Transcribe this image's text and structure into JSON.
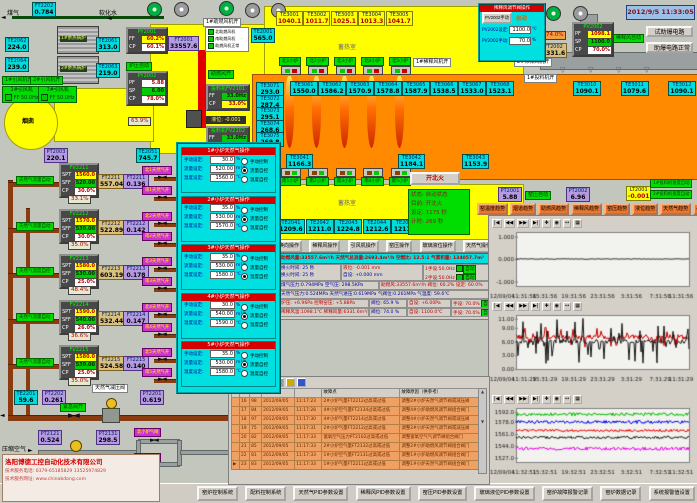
{
  "app": {
    "datetime": "2012/9/5 11:33:05"
  },
  "labels": {
    "spt": "SPT",
    "sff": "SFF",
    "cp": "CP",
    "pf": "PF",
    "ff": "FF",
    "sp": "SP"
  },
  "top_left": {
    "gas_label": "煤气",
    "water_label": "软化水",
    "ft2202": {
      "tag": "FT2202",
      "value": "0.784"
    },
    "boiler1": "1#余热锅炉",
    "boiler2": "2#余热锅炉",
    "te2062": {
      "tag": "TE2062",
      "value": "224.0"
    },
    "te2061": {
      "tag": "TE2061",
      "value": "313.0"
    },
    "te2064": {
      "tag": "TE2064",
      "value": "239.0"
    },
    "te2063": {
      "tag": "TE2063",
      "value": "219.0"
    },
    "fan1_status": "1#引风机开",
    "fan2_status": "2#引风机开",
    "fan1_name": "1#引风机",
    "fan2_name": "2#引风机",
    "fan1_ff": "FF 50.0Hz",
    "fan2_ff": "FF 50.0Hz",
    "py2001": {
      "tag": "PY2001",
      "ff": "60.2%",
      "cp": "60.1%"
    },
    "ft2001": {
      "tag": "FT2001",
      "value": "33557.6"
    },
    "blower1_status": "1#助燃风机开",
    "blower_legend": [
      "北助燃风机",
      "南助燃风机",
      "助燃风机正常"
    ],
    "press_auto": "炉压自动",
    "py2002": {
      "tag": "PY2002",
      "pf": "5.88",
      "sp": "6.00",
      "cp": "78.0%"
    },
    "chimney": "烟囱",
    "stack_pct": "63.9%",
    "pt2003": {
      "tag": "PT2003",
      "value": "220.1"
    },
    "te2051": {
      "tag": "TE2051",
      "value": "745.7"
    },
    "comb_air": "助燃风开",
    "te2001": {
      "tag": "TE2001",
      "value": "565.0"
    },
    "feeder1": {
      "name": "投料机FV2101",
      "ff": "33.0Hz",
      "cp": "33.0%"
    },
    "feeder2": {
      "name": "投料机FV2102",
      "ff": "33.0Hz",
      "cp": "33.0%"
    },
    "level": "液位: -0.001"
  },
  "furnace": {
    "regen_label": "蓄热室",
    "south_regen_label": "蓄热室",
    "crown_boxes": [
      {
        "tag": "TE3001",
        "value": "1040.1"
      },
      {
        "tag": "TE3002",
        "value": "1011.7"
      },
      {
        "tag": "TE3003",
        "value": "1025.1"
      },
      {
        "tag": "TE3004",
        "value": "1013.3"
      },
      {
        "tag": "TE3005",
        "value": "1041.7"
      }
    ],
    "north_burners": [
      {
        "label": "北1小炉"
      },
      {
        "label": "北2小炉"
      },
      {
        "label": "北3小炉"
      },
      {
        "label": "北4小炉"
      },
      {
        "label": "北5小炉"
      }
    ],
    "melt_temps": [
      {
        "tag": "TE3061",
        "value": "1550.0"
      },
      {
        "tag": "TE3062",
        "value": "1586.2"
      },
      {
        "tag": "TE3063",
        "value": "1570.9"
      },
      {
        "tag": "TE3064",
        "value": "1578.8"
      },
      {
        "tag": "TE3065",
        "value": "1587.9"
      },
      {
        "tag": "TE3066",
        "value": "1538.5"
      },
      {
        "tag": "TE3067",
        "value": "1533.0"
      },
      {
        "tag": "TE3068",
        "value": "1523.1"
      }
    ],
    "side_temps": [
      {
        "tag": "TE3071",
        "value": "293.0"
      },
      {
        "tag": "TE3072",
        "value": "287.4"
      },
      {
        "tag": "TE3073",
        "value": "295.1"
      },
      {
        "tag": "TE3074",
        "value": "268.6"
      },
      {
        "tag": "TE3075",
        "value": "269.8"
      }
    ],
    "right_temps": [
      {
        "tag": "TE3010",
        "value": "1090.1"
      },
      {
        "tag": "TE3011",
        "value": "1079.6"
      },
      {
        "tag": "TE3012",
        "value": "1090.1"
      }
    ],
    "south_top_temps": [
      {
        "tag": "TE3041",
        "value": "1166.3"
      },
      {
        "tag": "TE3042",
        "value": "1184.1"
      },
      {
        "tag": "TE3043",
        "value": "1153.9"
      }
    ],
    "south_burners": [
      {
        "label": "南1小炉"
      },
      {
        "label": "南2小炉"
      },
      {
        "label": "南3小炉"
      },
      {
        "label": "南4小炉"
      },
      {
        "label": "南5小炉"
      }
    ],
    "south_temps": [
      {
        "tag": "TE2041",
        "value": "1209.6"
      },
      {
        "tag": "TE2042",
        "value": "1211.0"
      },
      {
        "tag": "TE2043",
        "value": "1224.8"
      },
      {
        "tag": "TE2044",
        "value": "1212.6"
      },
      {
        "tag": "TE2045",
        "value": "1211.6"
      }
    ]
  },
  "dilution_popup": {
    "title": "稀释风调节阀操作",
    "manual_btn": "PV2002手动",
    "mode": "自动",
    "set_label": "PV2002设定:",
    "set_value": "1100.0",
    "set_unit": "℃",
    "man_label": "PV2002手动:",
    "man_value": "70.0",
    "man_unit": "%"
  },
  "dilution": {
    "pv2002": {
      "tag": "PV2002",
      "pf": "1098.1",
      "sp": "1100.0",
      "cp": "70.0%"
    },
    "pct": "74.0%",
    "ft2002": {
      "tag": "FT2002",
      "value": "6331.6"
    },
    "auto_label": "稀释风自动",
    "fan2_status": "2#稀释风机开",
    "fan1_status": "1#稀释风机开",
    "feeder_status": "1#投料机开",
    "test_btn": "试助爆电路",
    "ok_label": "助爆电路正常"
  },
  "fire": {
    "button": "开北火",
    "status_rows": [
      "状态: 自动状态",
      "目前: 开北火",
      "设定: 1175 秒",
      "计时: 269 秒"
    ]
  },
  "op_buttons": [
    "换向操作",
    "稀释风操作",
    "引风机操作",
    "窑压操作",
    "玻璃液位操作",
    "天然气操作"
  ],
  "info": {
    "line1": "助燃风量:33557.6m³/h  天然气总流量:2693.4m³/h  空燃比: 12.5:1  气累积量: 134057.7m³",
    "fire_time1": "换火时间:  25 秒",
    "fire_time2": "换火时间:  25 秒",
    "level": "液位:  -0.001 mm",
    "level_set": "自设:  +0.000 mm",
    "hand1": "1手设:50.0Hz",
    "hand1_mode": "自动",
    "hand2": "2手设:50.0Hz",
    "hand2_mode": "自动",
    "line3a": "煤气压力:0.794MPa  空气压: 298.5KPa",
    "line3b": "助燃风:33557.6m³/h 阀位: 60.2% 设定: 60.0%",
    "line4": "天然气压力:0.524MPa  天然气进压:0.619MPa  气阀位:0.261MPa  气温度: 59.6℃",
    "line5a": "炉压: +6.96Pa  控制窑压: +5.88Pa",
    "line5b": "阀位: 65.9 %",
    "line5c": "自设: +6.00Pa",
    "line5d": "手设: 70.0%",
    "line5e": "自动",
    "line6a": "稀释风温:1098.1℃ 稀释风量:6331.6m³/h",
    "line6b": "阀位: 74.0 %",
    "line6c": "自设: 1100.0℃",
    "line6d": "手设: 70.0%",
    "line6e": "自动"
  },
  "right_meters": {
    "pt2001": {
      "tag": "PT2001",
      "value": "5.88"
    },
    "kiln_auto": "窑压自动",
    "pt2002": {
      "tag": "PT2002",
      "value": "6.96"
    },
    "lt2001": {
      "tag": "LT2001",
      "value": "-0.001"
    },
    "feeder1_auto": "1#投料机速度自动",
    "feeder2_auto": "2#投料机速度自动"
  },
  "trend_buttons": [
    "窑温度趋势",
    "烟道趋势",
    "助燃风趋势",
    "稀释风趋势",
    "窑压趋势",
    "液位趋势",
    "天然气趋势",
    "小炉气趋势"
  ],
  "chart_toolbar": [
    {
      "icon": "|◀"
    },
    {
      "icon": "◀◀"
    },
    {
      "icon": "▶▶"
    },
    {
      "icon": "▶|"
    },
    {
      "icon": "✚"
    },
    {
      "icon": "◉"
    },
    {
      "icon": "↔"
    },
    {
      "icon": "▦"
    }
  ],
  "chart_data": [
    {
      "type": "line",
      "ylim": [
        -1.2,
        1.2
      ],
      "yticks": [
        1,
        0,
        -1
      ],
      "ytick_labels": [
        "1.000",
        "0.000",
        "-1.000"
      ],
      "date_label": "12/09/04",
      "xticks": [
        "11:31:56",
        "15:31:56",
        "19:31:56",
        "23:31:56",
        "3:31:56",
        "7:31:56",
        "11:31:56"
      ],
      "series": [
        {
          "color": "#303030",
          "base": 0,
          "noise": 0.015
        }
      ]
    },
    {
      "type": "line",
      "ylim": [
        0,
        11.8
      ],
      "yticks": [
        11,
        9,
        6,
        3,
        0
      ],
      "ytick_labels": [
        "11.00",
        "9.00",
        "6.00",
        "3.00",
        "0.00"
      ],
      "date_label": "12/09/04",
      "xticks": [
        "11:31:29",
        "15:31:29",
        "19:31:29",
        "23:31:29",
        "3:31:29",
        "7:31:29",
        "11:31:29"
      ],
      "series": [
        {
          "color": "#cc0000",
          "base": 7.0,
          "noise": 0.5,
          "spike": 2.2,
          "spike_prob": 0.25
        },
        {
          "color": "#181818",
          "base": 6.0,
          "noise": 0.4,
          "spike": 5.0,
          "spike_prob": 0.35
        }
      ]
    },
    {
      "type": "line",
      "ylim": [
        1521,
        1598
      ],
      "yticks": [
        1592,
        1578,
        1561,
        1544,
        1527
      ],
      "ytick_labels": [
        "1592.0",
        "1578.0",
        "1561.0",
        "1544.0",
        "1527.0"
      ],
      "date_label": "12/09/04",
      "xticks": [
        "11:32:51",
        "15:32:51",
        "19:32:51",
        "23:32:51",
        "3:32:51",
        "7:32:51",
        "11:32:51"
      ],
      "series": [
        {
          "color": "#00bb00",
          "base": 1589,
          "noise": 2.2
        },
        {
          "color": "#0000ee",
          "base": 1578,
          "noise": 2.2
        },
        {
          "color": "#ee0000",
          "base": 1566,
          "noise": 1.8
        },
        {
          "color": "#181818",
          "base": 1556,
          "noise": 1.8
        },
        {
          "color": "#ee00ee",
          "base": 1540,
          "noise": 2.2
        }
      ]
    }
  ],
  "popup": {
    "labels": {
      "manual": "手动设定:",
      "flow": "流量设定:",
      "temp": "温度设定:",
      "unit_manual": "%",
      "unit_flow": "m³/h",
      "unit_temp": "℃",
      "radio0": "手动控制",
      "radio1": "流量自控",
      "radio2": "温度自控"
    },
    "panels": [
      {
        "title": "1#小炉天然气操作",
        "manual": "30.0",
        "flow": "520.00",
        "temp": "1560.0",
        "selected": 1
      },
      {
        "title": "2#小炉天然气操作",
        "manual": "35.0",
        "flow": "530.00",
        "temp": "1570.0",
        "selected": 1
      },
      {
        "title": "3#小炉天然气操作",
        "manual": "35.0",
        "flow": "530.00",
        "temp": "1580.0",
        "selected": 2
      },
      {
        "title": "4#小炉天然气操作",
        "manual": "30.0",
        "flow": "540.00",
        "temp": "1590.0",
        "selected": 1
      },
      {
        "title": "5#小炉天然气操作",
        "manual": "35.0",
        "flow": "530.00",
        "temp": "1580.0",
        "selected": 1
      }
    ]
  },
  "gas_groups": [
    {
      "mode": "天然气流量自动",
      "fv": "FV2211",
      "spt": "1560.0",
      "sff": "520.00",
      "cp": "30.0%",
      "flow": {
        "tag": "FT2211",
        "value": "557.04"
      },
      "press": {
        "tag": "FT2211",
        "value": "0.136"
      },
      "pct": "33.1%",
      "valve_n": "北1天然气开",
      "valve_s": "南1天然气开"
    },
    {
      "mode": "天然气流量自动",
      "fv": "FV2212",
      "spt": "1570.0",
      "sff": "530.00",
      "cp": "30.0%",
      "flow": {
        "tag": "FT2212",
        "value": "522.89"
      },
      "press": {
        "tag": "FT2212",
        "value": "0.142"
      },
      "pct": "35.0%",
      "valve_n": "北2天然气开",
      "valve_s": "南2天然气开"
    },
    {
      "mode": "天然气温度自控",
      "fv": "FV2213",
      "spt": "1580.0",
      "sff": "530.00",
      "cp": "25.0%",
      "flow": {
        "tag": "FT2213",
        "value": "603.19"
      },
      "press": {
        "tag": "FT2213",
        "value": "0.178"
      },
      "pct": "48.4%",
      "valve_n": "北3天然气开",
      "valve_s": "南3天然气开"
    },
    {
      "mode": "天然气流量自动",
      "fv": "FV2214",
      "spt": "1590.0",
      "sff": "540.00",
      "cp": "26.0%",
      "flow": {
        "tag": "FT2214",
        "value": "532.44"
      },
      "press": {
        "tag": "FT2214",
        "value": "0.147"
      },
      "pct": "36.6%",
      "valve_n": "北4天然气开",
      "valve_s": "南4天然气开"
    },
    {
      "mode": "天然气流量自动",
      "fv": "FV2215",
      "spt": "1580.0",
      "sff": "530.00",
      "cp": "25.0%",
      "flow": {
        "tag": "FT2215",
        "value": "524.58"
      },
      "press": {
        "tag": "FT2215",
        "value": "0.140"
      },
      "pct": "35.0%",
      "valve_n": "北5天然气开",
      "valve_s": "南5天然气开"
    }
  ],
  "pipes_bottom": {
    "te2201": {
      "tag": "TE2201",
      "value": "59.6"
    },
    "pt2202": {
      "tag": "PT2202",
      "value": "0.261"
    },
    "emerg": "紧急阀开",
    "reducer": "天然气减压阀",
    "pt2201": {
      "tag": "PT2201",
      "value": "0.619"
    },
    "comp_air": "压缩空气",
    "pt2121": {
      "tag": "PT2121",
      "value": "0.524"
    },
    "pt2131": {
      "tag": "PT2131",
      "value": "298.5"
    },
    "valve_n": "北小炉气阀",
    "valve_s": "南小炉气阀"
  },
  "alarm": {
    "col_point": "故障点",
    "col_reason": "故障原因（供参考）",
    "rows": [
      {
        "marker": "",
        "no": "16",
        "code": "98",
        "date": "2012/09/05",
        "time": "11:17:23",
        "point": "2#小炉气量FT2212过高或过低",
        "reason": "调整2#小炉天然气调节阀或减压阀"
      },
      {
        "marker": "",
        "no": "17",
        "code": "84",
        "date": "2012/09/05",
        "time": "11:17:28",
        "point": "4#小炉空气量FT2134过高或过低",
        "reason": "调整4#小炉助燃风调节阀组合阀门"
      },
      {
        "marker": "",
        "no": "18",
        "code": "97",
        "date": "2012/09/05",
        "time": "11:17:30",
        "point": "4#小炉气量FT2214过高或过低",
        "reason": "调整4#小炉天然气调节阀或减压阀"
      },
      {
        "marker": "",
        "no": "19",
        "code": "75",
        "date": "2012/09/05",
        "time": "11:17:31",
        "point": "2#小炉气量FT2212过高或过低",
        "reason": "调整2#小炉天然气调节阀或减压阀"
      },
      {
        "marker": "",
        "no": "20",
        "code": "82",
        "date": "2012/09/05",
        "time": "11:17:33",
        "point": "富氧空气压力PT2102过高或过低",
        "reason": "调整富氧空气气调节阀组合阀门"
      },
      {
        "marker": "",
        "no": "21",
        "code": "85",
        "date": "2012/09/05",
        "time": "11:17:33",
        "point": "2#小炉空气量FT2132过高或过低",
        "reason": "调整2#小炉助燃风调节阀组合阀门"
      },
      {
        "marker": "",
        "no": "22",
        "code": "81",
        "date": "2012/09/05",
        "time": "11:17:33",
        "point": "1#小炉空气量FT2131过高或过低",
        "reason": "调整1#小炉助燃风调节阀组合阀门"
      },
      {
        "marker": "▶",
        "no": "23",
        "code": "83",
        "date": "2012/09/05",
        "time": "11:17:33",
        "point": "1#小炉气量FT2211过高或过低",
        "reason": "调整1#小炉天然气调节阀组合阀门"
      }
    ]
  },
  "bottom_buttons": [
    "窑炉控制系统",
    "配料控制系统",
    "天然气PID参数设置",
    "稀释风PID参数设置",
    "窑压PID参数设置",
    "玻璃液位PID参数设置",
    "窑炉故障报警记录",
    "窑炉数据记录",
    "系统报警值设置"
  ],
  "company": {
    "name": "洛阳博德工控自动化技术有限公司",
    "phone": "技术服务电话: 0379-65185829  13525974829",
    "web": "技术服务网址: www.chinabdong.com"
  }
}
